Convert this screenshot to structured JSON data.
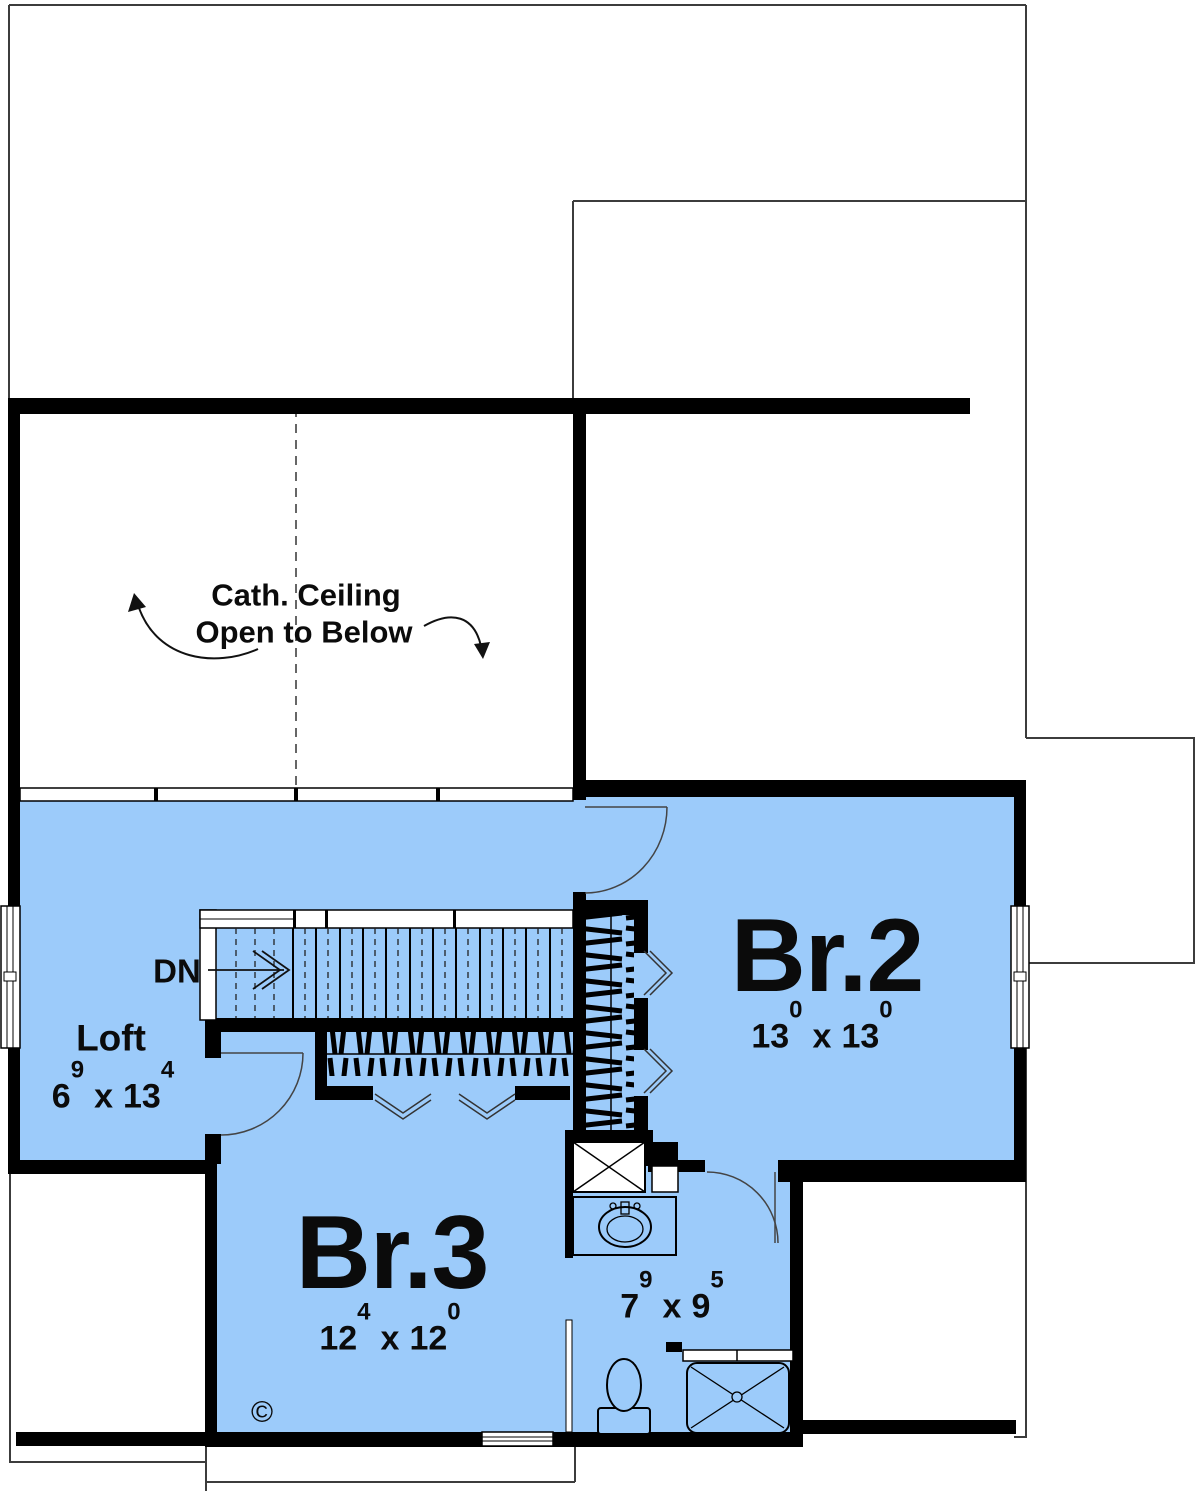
{
  "colors": {
    "floor_fill": "#9CCBFA",
    "walls": "#000000",
    "roof_outline": "#3C3C3C"
  },
  "annotations": {
    "cathedral_line1": "Cath. Ceiling",
    "cathedral_line2": "Open to Below",
    "stairs_direction": "DN",
    "copyright_symbol": "©"
  },
  "rooms": {
    "loft": {
      "name": "Loft",
      "dim": {
        "a": "6",
        "a_sup": "9",
        "sep": "x",
        "b": "13",
        "b_sup": "4"
      }
    },
    "bedroom2": {
      "name": "Br.2",
      "dim": {
        "a": "13",
        "a_sup": "0",
        "sep": "x",
        "b": "13",
        "b_sup": "0"
      }
    },
    "bedroom3": {
      "name": "Br.3",
      "dim": {
        "a": "12",
        "a_sup": "4",
        "sep": "x",
        "b": "12",
        "b_sup": "0"
      }
    },
    "bathroom": {
      "dim": {
        "a": "7",
        "a_sup": "9",
        "sep": "x",
        "b": "9",
        "b_sup": "5"
      }
    }
  }
}
